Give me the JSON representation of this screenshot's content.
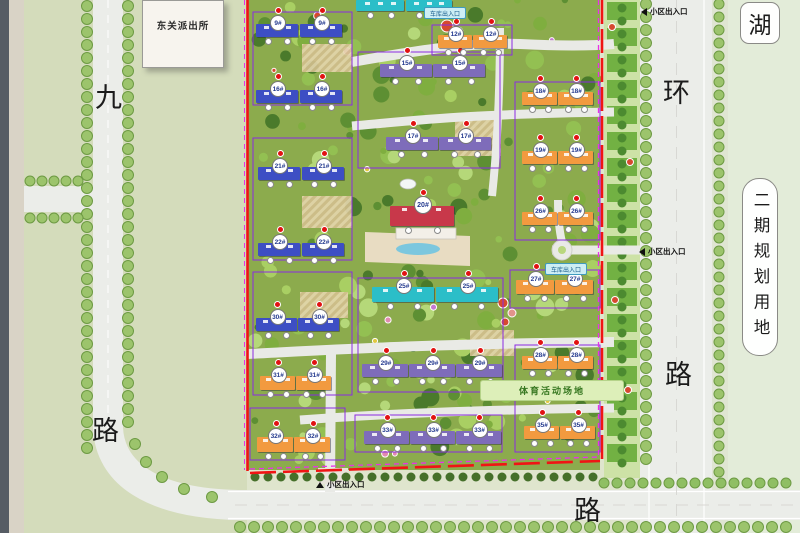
{
  "map": {
    "police_label": "东关派出所",
    "lake_label": "湖",
    "phase2_label": "二期规划用地",
    "sports_label": "体育活动场地",
    "entrance_label": "小区出入口",
    "garage_label": "车库出入口",
    "road_labels": [
      {
        "id": "jiu",
        "text": "九",
        "x": 95,
        "y": 85
      },
      {
        "id": "lu-left",
        "text": "路",
        "x": 92,
        "y": 418
      },
      {
        "id": "huan",
        "text": "环",
        "x": 663,
        "y": 80
      },
      {
        "id": "lu-right",
        "text": "路",
        "x": 665,
        "y": 362
      },
      {
        "id": "lu-bottom",
        "text": "路",
        "x": 574,
        "y": 498
      }
    ]
  },
  "colors": {
    "blue": "#3d4ec4",
    "purple": "#7e6cba",
    "cyan": "#2bbec8",
    "orange": "#f29a3f",
    "red": "#c8384a",
    "boundary_red": "#f01414",
    "boundary_magenta": "#e832e8",
    "cluster_violet": "#8a2be2"
  },
  "buildings": [
    {
      "n": "9#",
      "c": "blue",
      "x": 256,
      "y": 24,
      "w": 42,
      "h": 13
    },
    {
      "n": "9#",
      "c": "blue",
      "x": 300,
      "y": 24,
      "w": 42,
      "h": 13
    },
    {
      "n": "16#",
      "c": "blue",
      "x": 256,
      "y": 90,
      "w": 42,
      "h": 13
    },
    {
      "n": "16#",
      "c": "blue",
      "x": 300,
      "y": 90,
      "w": 42,
      "h": 13
    },
    {
      "n": "21#",
      "c": "blue",
      "x": 258,
      "y": 167,
      "w": 42,
      "h": 13
    },
    {
      "n": "21#",
      "c": "blue",
      "x": 302,
      "y": 167,
      "w": 42,
      "h": 13
    },
    {
      "n": "22#",
      "c": "blue",
      "x": 258,
      "y": 243,
      "w": 42,
      "h": 13
    },
    {
      "n": "22#",
      "c": "blue",
      "x": 302,
      "y": 243,
      "w": 42,
      "h": 13
    },
    {
      "n": "30#",
      "c": "blue",
      "x": 256,
      "y": 318,
      "w": 41,
      "h": 13
    },
    {
      "n": "30#",
      "c": "blue",
      "x": 298,
      "y": 318,
      "w": 41,
      "h": 13
    },
    {
      "n": "31#",
      "c": "orange",
      "x": 260,
      "y": 376,
      "w": 35,
      "h": 14
    },
    {
      "n": "31#",
      "c": "orange",
      "x": 296,
      "y": 376,
      "w": 35,
      "h": 14
    },
    {
      "n": "32#",
      "c": "orange",
      "x": 257,
      "y": 437,
      "w": 36,
      "h": 15
    },
    {
      "n": "32#",
      "c": "orange",
      "x": 294,
      "y": 437,
      "w": 36,
      "h": 15
    },
    {
      "n": "15#",
      "c": "purple",
      "x": 380,
      "y": 64,
      "w": 52,
      "h": 13
    },
    {
      "n": "15#",
      "c": "purple",
      "x": 433,
      "y": 64,
      "w": 52,
      "h": 13
    },
    {
      "n": "17#",
      "c": "purple",
      "x": 386,
      "y": 137,
      "w": 52,
      "h": 13
    },
    {
      "n": "17#",
      "c": "purple",
      "x": 439,
      "y": 137,
      "w": 52,
      "h": 13
    },
    {
      "n": "",
      "c": "cyan",
      "x": 356,
      "y": 0,
      "w": 48,
      "h": 11
    },
    {
      "n": "",
      "c": "cyan",
      "x": 406,
      "y": 0,
      "w": 46,
      "h": 11
    },
    {
      "n": "25#",
      "c": "cyan",
      "x": 372,
      "y": 287,
      "w": 62,
      "h": 15
    },
    {
      "n": "25#",
      "c": "cyan",
      "x": 436,
      "y": 287,
      "w": 62,
      "h": 15
    },
    {
      "n": "29#",
      "c": "purple",
      "x": 362,
      "y": 364,
      "w": 46,
      "h": 13
    },
    {
      "n": "29#",
      "c": "purple",
      "x": 409,
      "y": 364,
      "w": 46,
      "h": 13
    },
    {
      "n": "29#",
      "c": "purple",
      "x": 456,
      "y": 364,
      "w": 46,
      "h": 13
    },
    {
      "n": "33#",
      "c": "purple",
      "x": 364,
      "y": 431,
      "w": 45,
      "h": 13
    },
    {
      "n": "33#",
      "c": "purple",
      "x": 410,
      "y": 431,
      "w": 45,
      "h": 13
    },
    {
      "n": "33#",
      "c": "purple",
      "x": 456,
      "y": 431,
      "w": 45,
      "h": 13
    },
    {
      "n": "12#",
      "c": "orange",
      "x": 438,
      "y": 35,
      "w": 34,
      "h": 13
    },
    {
      "n": "12#",
      "c": "orange",
      "x": 473,
      "y": 35,
      "w": 34,
      "h": 13
    },
    {
      "n": "18#",
      "c": "orange",
      "x": 522,
      "y": 92,
      "w": 35,
      "h": 13
    },
    {
      "n": "18#",
      "c": "orange",
      "x": 558,
      "y": 92,
      "w": 35,
      "h": 13
    },
    {
      "n": "19#",
      "c": "orange",
      "x": 522,
      "y": 151,
      "w": 35,
      "h": 13
    },
    {
      "n": "19#",
      "c": "orange",
      "x": 558,
      "y": 151,
      "w": 35,
      "h": 13
    },
    {
      "n": "26#",
      "c": "orange",
      "x": 522,
      "y": 212,
      "w": 35,
      "h": 13
    },
    {
      "n": "26#",
      "c": "orange",
      "x": 558,
      "y": 212,
      "w": 35,
      "h": 13
    },
    {
      "n": "27#",
      "c": "orange",
      "x": 516,
      "y": 280,
      "w": 38,
      "h": 14
    },
    {
      "n": "27#",
      "c": "orange",
      "x": 555,
      "y": 280,
      "w": 38,
      "h": 14
    },
    {
      "n": "28#",
      "c": "orange",
      "x": 522,
      "y": 356,
      "w": 35,
      "h": 13
    },
    {
      "n": "28#",
      "c": "orange",
      "x": 558,
      "y": 356,
      "w": 35,
      "h": 13
    },
    {
      "n": "35#",
      "c": "orange",
      "x": 524,
      "y": 426,
      "w": 35,
      "h": 13
    },
    {
      "n": "35#",
      "c": "orange",
      "x": 560,
      "y": 426,
      "w": 35,
      "h": 13
    },
    {
      "n": "20#",
      "c": "red",
      "x": 390,
      "y": 206,
      "w": 64,
      "h": 20,
      "big": true
    }
  ]
}
